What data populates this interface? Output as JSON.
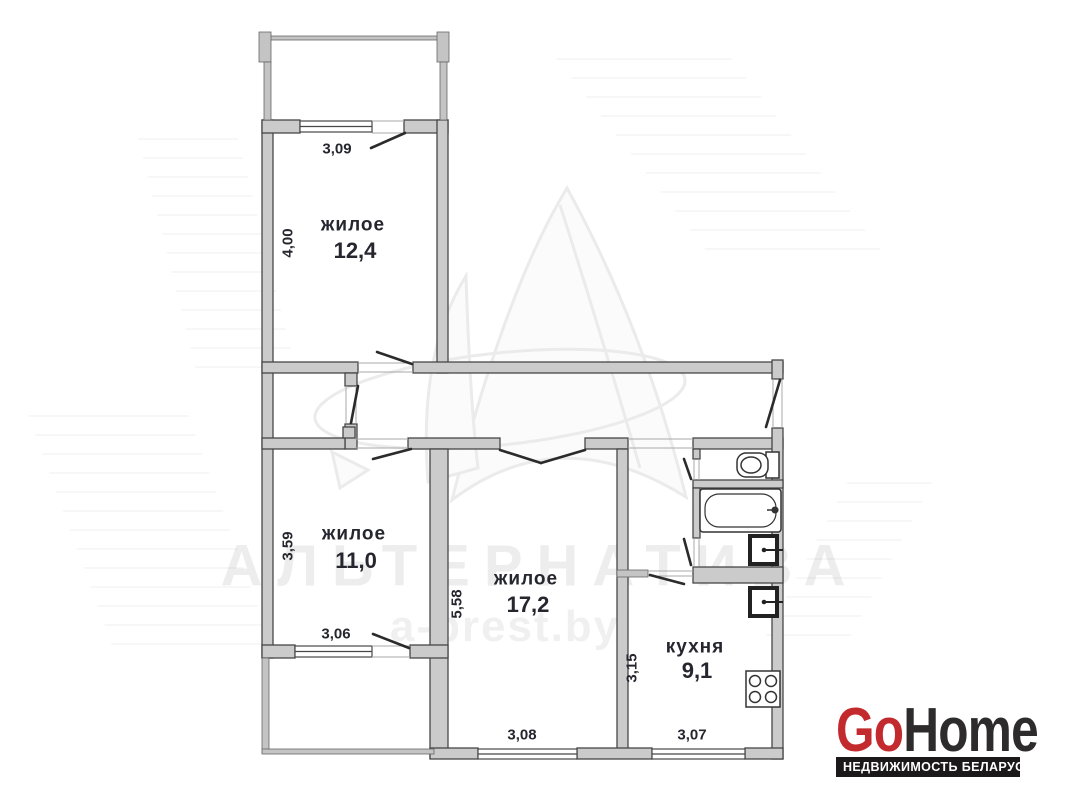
{
  "plan": {
    "rooms": [
      {
        "label": "жилое",
        "area": "12,4",
        "width_dim": "3,09",
        "height_dim": "4,00"
      },
      {
        "label": "жилое",
        "area": "11,0",
        "width_dim": "3,06",
        "height_dim": "3,59"
      },
      {
        "label": "жилое",
        "area": "17,2",
        "width_dim": "3,08",
        "height_dim": "5,58"
      },
      {
        "label": "кухня",
        "area": "9,1",
        "width_dim": "3,07",
        "height_dim": "3,15"
      }
    ],
    "fixtures": [
      "toilet-icon",
      "bathtub-icon",
      "washbasin-icon",
      "kitchen-sink-icon",
      "stove-icon"
    ]
  },
  "watermark": {
    "agency": "АЛЬТЕРНАТИВА",
    "site": "a-brest.by"
  },
  "logo": {
    "go": "Go",
    "home": "Home",
    "tagline": "НЕДВИЖИМОСТЬ БЕЛАРУСИ",
    "go_color": "#c22a2e",
    "home_color": "#2d2b2c",
    "bar_color": "#1b1919"
  }
}
